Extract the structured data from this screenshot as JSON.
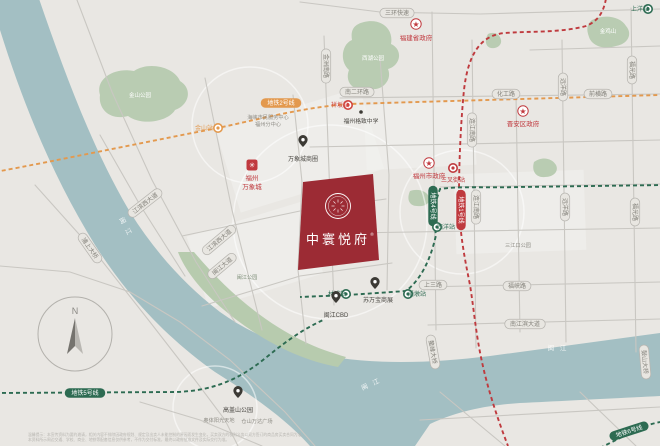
{
  "project": {
    "name": "中寰悦府",
    "trademark": "®",
    "block_color": "#9c2b34",
    "block_pts": "303,182 373,174 379,260 298,270",
    "logo_cx": 338,
    "logo_cy": 206,
    "name_x": 338,
    "name_y": 244
  },
  "compass": {
    "n_label": "N",
    "cx": 75,
    "cy": 334,
    "r": 37
  },
  "disclaimer": [
    "温馨提示：本宣传资料为要约邀请，相关内容不排除因政府规划、规定及出卖人未能控制的原因而发生变化，买卖双方的权利义务以双方签订的商品房买卖合同为准。",
    "本资料所示周边交通、学校、商业、地铁等配套信息仅供参考，不作为交付标准，最终以政府批准文件及实际交付为准。"
  ],
  "colors": {
    "land": "#e9e7e3",
    "river": "#a3bfc3",
    "park": "#b9ccb2",
    "strip": "#b7cbae",
    "road": "#c9c7c2",
    "capsule_fill": "#e8e6e1",
    "capsule_stroke": "#b7b5b0",
    "capsule_text": "#83817a",
    "line_red": "#bf3a3e",
    "line_orange": "#e3994e",
    "line_green": "#2d6b52",
    "poi_dark": "#3c3a35",
    "gov_red": "#c0393e",
    "label_gray": "#8f8d86",
    "white": "#ffffff"
  },
  "map": {
    "river_path": "M36 -10 C60 60 90 145 130 212 C155 252 185 285 220 312 C255 337 295 352 340 358 C390 365 440 362 490 356 L660 333 L660 396 C600 399 560 401 520 403 C490 405 460 410 430 424 L415 446 L310 446 C285 418 250 394 215 372 C170 340 130 300 95 245 C55 180 25 110 0 30 L0 -10 Z",
    "green_strip": "M194 252 C226 290 262 321 303 341 C317 348 332 353 346 357 L338 367 C294 359 252 335 216 303 C197 286 183 266 178 252 Z",
    "parks": [
      "M100 95 C95 79 114 67 134 71 C149 61 174 67 180 81 C193 89 189 105 175 110 C168 122 141 126 128 116 C110 121 98 109 100 95 Z",
      "M364 22 C380 18 394 28 391 44 C404 50 400 66 388 69 C393 81 380 93 368 88 C355 93 344 83 349 70 C339 61 342 44 352 40 C350 28 356 24 364 22 Z",
      "M592 20 C604 14 620 16 626 26 C633 34 628 44 616 46 C604 50 592 46 589 37 C586 29 587 24 592 20 Z",
      "M534 162 C542 156 552 158 556 165 C559 171 554 177 545 177 C537 178 531 172 534 162 Z",
      "M410 191 C418 188 427 191 429 197 C431 203 425 207 417 206 C410 206 406 200 410 191 Z",
      "M488 34 C494 31 500 34 501 40 C502 45 497 49 491 48 C486 47 484 41 488 34 Z"
    ],
    "blocks": [
      {
        "cx": 300,
        "cy": 150,
        "w": 150,
        "h": 85,
        "rot": -17
      },
      {
        "cx": 255,
        "cy": 255,
        "w": 120,
        "h": 75,
        "rot": -17
      },
      {
        "cx": 420,
        "cy": 135,
        "w": 110,
        "h": 65,
        "rot": -3
      },
      {
        "cx": 520,
        "cy": 212,
        "w": 130,
        "h": 80,
        "rot": -2
      }
    ],
    "roads": [
      "77,0 112,92 152,180 196,262 235,322",
      "300,2 380,12 480,14 660,9",
      "0,266 70,272 130,292 180,322 230,360 285,412 315,446",
      "35,185 95,252 150,322 195,380 225,420 238,446",
      "100,135 140,205 185,276",
      "205,78 232,210 262,330",
      "293,95 302,182 298,270 306,344",
      "380,58 389,175 387,290",
      "182,236 300,211 386,199",
      "202,306 300,276 392,263",
      "324,36 334,305",
      "432,12 436,330",
      "472,40 476,348",
      "516,95 520,332",
      "562,40 566,342",
      "631,8 636,352",
      "310,147 660,140",
      "350,233 660,228",
      "420,287 660,282",
      "428,325 660,319",
      "530,50 660,46",
      "340,98 660,94",
      "440,187 660,184",
      "420,420 660,407",
      "440,392 505,446",
      "580,392 636,446",
      "140,402 200,420 262,446"
    ],
    "rings": [
      {
        "x": 330,
        "y": 222,
        "r": 97
      },
      {
        "x": 250,
        "y": 125,
        "r": 58
      },
      {
        "x": 462,
        "y": 212,
        "r": 62
      },
      {
        "x": 215,
        "y": 408,
        "r": 42
      }
    ],
    "metro_lines": [
      {
        "name": "metro-line-1",
        "color": "#bf3a3e",
        "d": "M607 -8 C605 8 601 20 586 26 C560 33 530 31 505 33 C480 35 468 55 464 90 C461 120 459 160 459 195 C459 230 464 255 470 285 C474 310 476 335 482 362 C488 390 498 420 508 446"
      },
      {
        "name": "metro-line-2",
        "color": "#e3994e",
        "d": "M-5 172 C60 160 140 143 218 128 C260 119 300 108 348 104 L660 95"
      },
      {
        "name": "metro-line-4",
        "color": "#2d6b52",
        "d": "M665 185 L520 187 C490 188 458 186 440 189 C434 205 433 218 436 235 C430 262 420 280 406 291 L348 295 L300 297"
      },
      {
        "name": "metro-line-5",
        "color": "#2d6b52",
        "d": "M-5 393 L175 392 C220 391 246 374 268 356 C290 338 306 328 323 320"
      },
      {
        "name": "metro-line-6",
        "color": "#2d6b52",
        "d": "M600 448 L628 434 C643 426 653 423 666 421"
      }
    ],
    "line_capsules": [
      {
        "text": "地铁1号线",
        "x": 461,
        "y": 210,
        "rot": 90,
        "color": "#bf3a3e"
      },
      {
        "text": "地铁2号线",
        "x": 281,
        "y": 103,
        "rot": 0,
        "color": "#e3994e"
      },
      {
        "text": "地铁4号线",
        "x": 433,
        "y": 206,
        "rot": 90,
        "color": "#2d6b52"
      },
      {
        "text": "地铁5号线",
        "x": 85,
        "y": 393,
        "rot": 0,
        "color": "#2d6b52"
      },
      {
        "text": "地铁6号线",
        "x": 629,
        "y": 431,
        "rot": -18,
        "color": "#2d6b52"
      }
    ],
    "road_capsules": [
      {
        "text": "金洲南路",
        "x": 326,
        "y": 66,
        "rot": 90
      },
      {
        "text": "连江南路",
        "x": 472,
        "y": 130,
        "rot": 90
      },
      {
        "text": "连江南路",
        "x": 476,
        "y": 207,
        "rot": 90
      },
      {
        "text": "远洋路",
        "x": 563,
        "y": 87,
        "rot": 90
      },
      {
        "text": "远洋路",
        "x": 565,
        "y": 207,
        "rot": 90
      },
      {
        "text": "福光路",
        "x": 632,
        "y": 70,
        "rot": 90
      },
      {
        "text": "福光路",
        "x": 635,
        "y": 212,
        "rot": 90
      },
      {
        "text": "南二环路",
        "x": 357,
        "y": 92,
        "rot": 0
      },
      {
        "text": "化工路",
        "x": 506,
        "y": 94,
        "rot": 0
      },
      {
        "text": "前横路",
        "x": 598,
        "y": 94,
        "rot": 0
      },
      {
        "text": "上三路",
        "x": 433,
        "y": 285,
        "rot": 0
      },
      {
        "text": "福峡路",
        "x": 517,
        "y": 286,
        "rot": 0
      },
      {
        "text": "南江滨大道",
        "x": 525,
        "y": 324,
        "rot": 0
      },
      {
        "text": "三环快速",
        "x": 397,
        "y": 13,
        "rot": 0
      },
      {
        "text": "江滨西大道",
        "x": 145,
        "y": 203,
        "rot": -38
      },
      {
        "text": "江滨西大道",
        "x": 219,
        "y": 240,
        "rot": -40
      },
      {
        "text": "闽江大道",
        "x": 222,
        "y": 266,
        "rot": -40
      },
      {
        "text": "浦上大桥",
        "x": 90,
        "y": 248,
        "rot": 55
      },
      {
        "text": "鳌峰大桥",
        "x": 433,
        "y": 352,
        "rot": 80
      },
      {
        "text": "鼓山大桥",
        "x": 645,
        "y": 362,
        "rot": 85
      }
    ],
    "stations": [
      {
        "x": 218,
        "y": 128,
        "color": "#e3994e",
        "label": "金山站",
        "lx": 204,
        "ly": 130,
        "anchor": "end"
      },
      {
        "x": 348,
        "y": 105,
        "color": "#d0453f",
        "label": "祥坂站",
        "lx": 340,
        "ly": 107,
        "anchor": "end"
      },
      {
        "x": 453,
        "y": 168,
        "color": "#bf3a3e",
        "label": "三叉街站",
        "lx": 453,
        "ly": 182,
        "anchor": "middle"
      },
      {
        "x": 437,
        "y": 227,
        "color": "#2d6b52",
        "label": "西洋站",
        "lx": 446,
        "ly": 229,
        "anchor": "start"
      },
      {
        "x": 346,
        "y": 294,
        "color": "#2d6b52",
        "label": "林浦站",
        "lx": 337,
        "ly": 296,
        "anchor": "end"
      },
      {
        "x": 408,
        "y": 294,
        "color": "#2d6b52",
        "label": "潘墩站",
        "lx": 417,
        "ly": 296,
        "anchor": "start"
      },
      {
        "x": 648,
        "y": 9,
        "color": "#2d6b52",
        "label": "上洋站",
        "lx": 640,
        "ly": 11,
        "anchor": "end"
      }
    ],
    "gov_pois": [
      {
        "label": "福建省政府",
        "x": 416,
        "y": 24,
        "lx": 416,
        "ly": 40
      },
      {
        "label": "福州市政府",
        "x": 429,
        "y": 163,
        "lx": 429,
        "ly": 178
      },
      {
        "label": "晋安区政府",
        "x": 523,
        "y": 111,
        "lx": 523,
        "ly": 126
      }
    ],
    "pins": [
      {
        "label": "万象城商圈",
        "x": 303,
        "y": 147,
        "lx": 303,
        "ly": 161
      },
      {
        "label": "苏万宝商展",
        "x": 375,
        "y": 289,
        "lx": 378,
        "ly": 302
      },
      {
        "label": "闽江CBD",
        "x": 336,
        "y": 303,
        "lx": 336,
        "ly": 317
      },
      {
        "label": "高盖山公园",
        "x": 238,
        "y": 398,
        "lx": 238,
        "ly": 412
      }
    ],
    "mixc": {
      "x": 252,
      "y": 165,
      "glyph": "✳",
      "label1": "福州",
      "label2": "万象城",
      "l1y": 180,
      "l2y": 189
    },
    "school": {
      "label": "福州格致中学",
      "x": 361,
      "y": 112,
      "lx": 361,
      "ly": 123
    },
    "labels": [
      {
        "t": "海峡市民服务中心",
        "x": 268,
        "y": 119
      },
      {
        "t": "福州分中心",
        "x": 268,
        "y": 126
      },
      {
        "t": "三江口公园",
        "x": 518,
        "y": 247
      },
      {
        "t": "奥体阳光天地",
        "x": 219,
        "y": 422
      },
      {
        "t": "仓山万达广场",
        "x": 257,
        "y": 423
      },
      {
        "t": "金山公园",
        "x": 140,
        "y": 97,
        "c": "#ffffff",
        "s": 5.5
      },
      {
        "t": "西湖公园",
        "x": 373,
        "y": 60,
        "c": "#ffffff",
        "s": 5.5
      },
      {
        "t": "金鸡山",
        "x": 608,
        "y": 33,
        "c": "#ffffff",
        "s": 5.5
      },
      {
        "t": "闽江公园",
        "x": 247,
        "y": 279,
        "c": "#7e8f79",
        "s": 5.2
      }
    ],
    "river_labels": [
      {
        "t": "闽 江",
        "x": 124,
        "y": 228,
        "r": 62
      },
      {
        "t": "闽 江",
        "x": 558,
        "y": 350,
        "r": 0
      },
      {
        "t": "闽 江",
        "x": 372,
        "y": 386,
        "r": -24
      }
    ]
  }
}
